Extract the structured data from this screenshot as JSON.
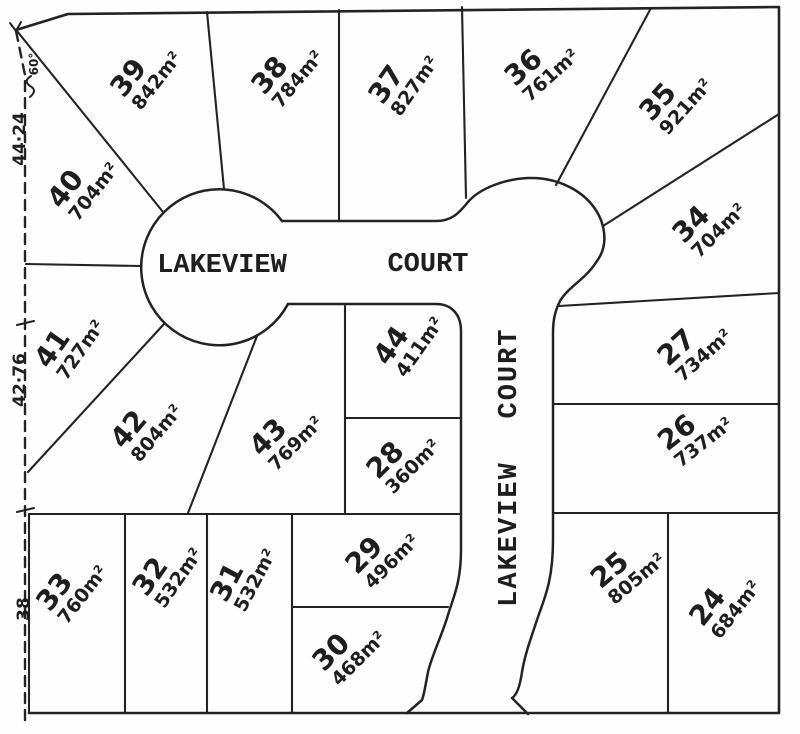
{
  "streets": {
    "horizontal": {
      "word1": "LAKEVIEW",
      "word2": "COURT"
    },
    "vertical": {
      "word1": "LAKEVIEW",
      "word2": "COURT"
    }
  },
  "lots": [
    {
      "number": "24",
      "area": "684m²"
    },
    {
      "number": "25",
      "area": "805m²"
    },
    {
      "number": "26",
      "area": "737m²"
    },
    {
      "number": "27",
      "area": "734m²"
    },
    {
      "number": "28",
      "area": "360m²"
    },
    {
      "number": "29",
      "area": "496m²"
    },
    {
      "number": "30",
      "area": "468m²"
    },
    {
      "number": "31",
      "area": "532m²"
    },
    {
      "number": "32",
      "area": "532m²"
    },
    {
      "number": "33",
      "area": "760m²"
    },
    {
      "number": "34",
      "area": "704m²"
    },
    {
      "number": "35",
      "area": "921m²"
    },
    {
      "number": "36",
      "area": "761m²"
    },
    {
      "number": "37",
      "area": "827m²"
    },
    {
      "number": "38",
      "area": "784m²"
    },
    {
      "number": "39",
      "area": "842m²"
    },
    {
      "number": "40",
      "area": "704m²"
    },
    {
      "number": "41",
      "area": "727m²"
    },
    {
      "number": "42",
      "area": "804m²"
    },
    {
      "number": "43",
      "area": "769m²"
    },
    {
      "number": "44",
      "area": "411m²"
    }
  ],
  "dimensions": {
    "angle": "60°",
    "west_upper": "44·24",
    "west_middle": "42·76",
    "west_lower": "38"
  },
  "colors": {
    "ink": "#232323",
    "paper": "#fefefe"
  }
}
